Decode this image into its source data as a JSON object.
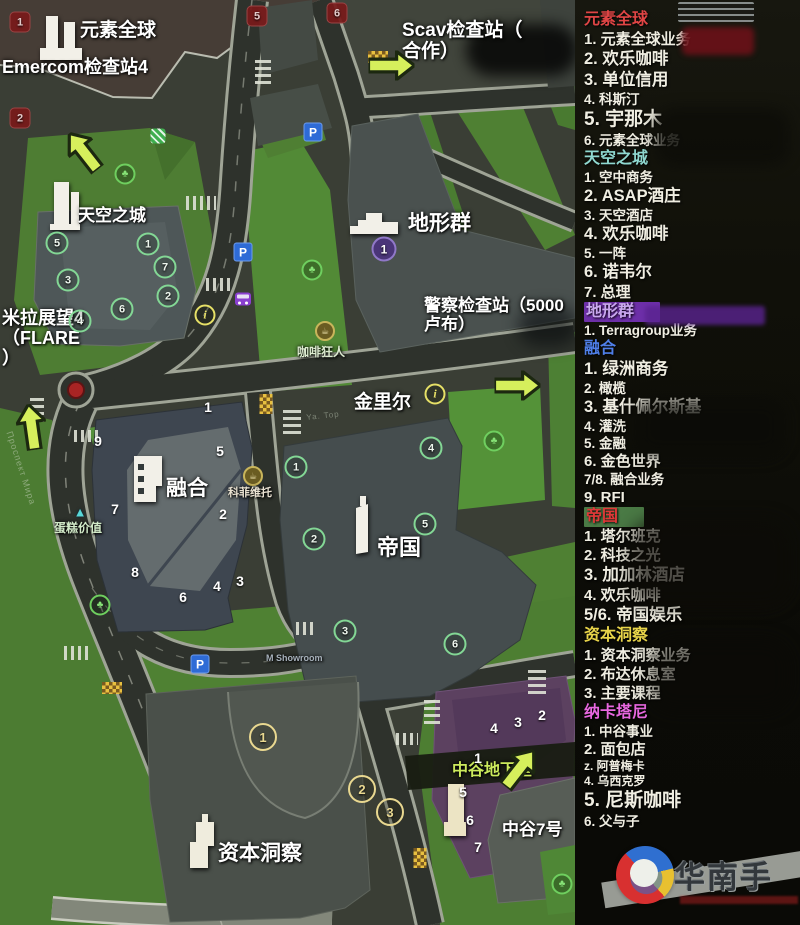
{
  "panel": {
    "sections": [
      {
        "id": "yuansuquanqiu",
        "title": "元素全球",
        "color": "#e04545",
        "bg": "",
        "items": [
          {
            "num": "1.",
            "text": "元素全球业务",
            "size": "md"
          },
          {
            "num": "2.",
            "text": "欢乐咖啡",
            "size": "lg"
          },
          {
            "num": "3.",
            "text": "单位信用",
            "size": "lg"
          },
          {
            "num": "4.",
            "text": "科斯汀",
            "size": "sm"
          },
          {
            "num": "5.",
            "text": "宇那木",
            "size": "xl"
          },
          {
            "num": "6.",
            "text": "元素全球业务",
            "size": "sm"
          }
        ]
      },
      {
        "id": "tiankongzhicheng",
        "title": "天空之城",
        "color": "#8fd8d0",
        "bg": "",
        "items": [
          {
            "num": "1.",
            "text": "空中商务",
            "size": "sm"
          },
          {
            "num": "2.",
            "text": "ASAP酒庄",
            "size": "lg"
          },
          {
            "num": "3.",
            "text": "天空酒店",
            "size": "sm"
          },
          {
            "num": "4.",
            "text": "欢乐咖啡",
            "size": "lg"
          },
          {
            "num": "5.",
            "text": "一阵",
            "size": "sm"
          },
          {
            "num": "6.",
            "text": "诺韦尔",
            "size": "lg"
          },
          {
            "num": "7.",
            "text": "总理",
            "size": "md"
          }
        ]
      },
      {
        "id": "dixingqun",
        "title": "地形群",
        "color": "#c9a8ee",
        "bg": "#6d2fa8",
        "items": [
          {
            "num": "1.",
            "text": "Terragroup业务",
            "size": "sm"
          }
        ]
      },
      {
        "id": "ronghe",
        "title": "融合",
        "color": "#4f7fe8",
        "bg": "",
        "items": [
          {
            "num": "1.",
            "text": "绿洲商务",
            "size": "lg"
          },
          {
            "num": "2.",
            "text": "橄榄",
            "size": "sm"
          },
          {
            "num": "3.",
            "text": "基什佩尔斯基",
            "size": "lg"
          },
          {
            "num": "4.",
            "text": "灌洗",
            "size": "sm"
          },
          {
            "num": "5.",
            "text": "金融",
            "size": "sm"
          },
          {
            "num": "6.",
            "text": "金色世界",
            "size": "md"
          },
          {
            "num": "7/8.",
            "text": "融合业务",
            "size": "sm"
          },
          {
            "num": "9.",
            "text": "RFI",
            "size": "md"
          }
        ]
      },
      {
        "id": "diguo",
        "title": "帝国",
        "color": "#e03838",
        "bg": "#4a7a45",
        "items": [
          {
            "num": "1.",
            "text": "塔尔班克",
            "size": "md"
          },
          {
            "num": "2.",
            "text": "科技之光",
            "size": "md"
          },
          {
            "num": "3.",
            "text": "加加林酒店",
            "size": "lg"
          },
          {
            "num": "4.",
            "text": "欢乐咖啡",
            "size": "md"
          },
          {
            "num": "5/6.",
            "text": "帝国娱乐",
            "size": "lg"
          }
        ]
      },
      {
        "id": "zibendongcha",
        "title": "资本洞察",
        "color": "#e8d44a",
        "bg": "",
        "items": [
          {
            "num": "1.",
            "text": "资本洞察业务",
            "size": "md"
          },
          {
            "num": "2.",
            "text": "布达休息室",
            "size": "md"
          },
          {
            "num": "3.",
            "text": "主要课程",
            "size": "md"
          }
        ]
      },
      {
        "id": "nakatani",
        "title": "纳卡塔尼",
        "color": "#e868e0",
        "bg": "",
        "items": [
          {
            "num": "1.",
            "text": "中谷事业",
            "size": "sm"
          },
          {
            "num": "2.",
            "text": "面包店",
            "size": "md"
          },
          {
            "num": "z.",
            "text": "阿普梅卡",
            "size": "xs"
          },
          {
            "num": "4.",
            "text": "乌西克罗",
            "size": "xs"
          },
          {
            "num": "5.",
            "text": "尼斯咖啡",
            "size": "xl"
          },
          {
            "num": "6.",
            "text": "父与子",
            "size": "sm"
          }
        ]
      }
    ]
  },
  "map": {
    "labels": [
      {
        "id": "yuansu",
        "text": "元素全球",
        "x": 80,
        "y": 20,
        "fs": 19
      },
      {
        "id": "emercom-checkpoint",
        "text": "Emercom检查站4",
        "x": 2,
        "y": 57,
        "fs": 18
      },
      {
        "id": "scav-checkpoint",
        "text": "Scav检查站（\n合作）",
        "x": 402,
        "y": 20,
        "fs": 19
      },
      {
        "id": "tiankong",
        "text": "天空之城",
        "x": 78,
        "y": 206,
        "fs": 17
      },
      {
        "id": "mila-flare",
        "text": "米拉展望4\n（FLARE\n）",
        "x": 2,
        "y": 308,
        "fs": 18
      },
      {
        "id": "dixing",
        "text": "地形群",
        "x": 408,
        "y": 212,
        "fs": 21
      },
      {
        "id": "police-checkpoint",
        "text": "警察检查站（5000\n卢布）",
        "x": 424,
        "y": 296,
        "fs": 17
      },
      {
        "id": "jinlier",
        "text": "金里尔",
        "x": 354,
        "y": 392,
        "fs": 19
      },
      {
        "id": "kafei-kuangren",
        "text": "咖啡狂人",
        "x": 297,
        "y": 346,
        "fs": 12,
        "color": "#dcead0"
      },
      {
        "id": "ronghe",
        "text": "融合",
        "x": 166,
        "y": 477,
        "fs": 21
      },
      {
        "id": "kefei-weituo",
        "text": "科菲维托",
        "x": 228,
        "y": 487,
        "fs": 11,
        "color": "#eae2d2"
      },
      {
        "id": "dangao-jiazhi",
        "text": "蛋糕价值",
        "x": 54,
        "y": 522,
        "fs": 12,
        "color": "#d2eac8"
      },
      {
        "id": "diguo",
        "text": "帝国",
        "x": 377,
        "y": 536,
        "fs": 22
      },
      {
        "id": "m-showroom",
        "text": "M Showroom",
        "x": 266,
        "y": 653,
        "fs": 9,
        "color": "#a8b2bc"
      },
      {
        "id": "ziben",
        "text": "资本洞察",
        "x": 218,
        "y": 842,
        "fs": 21
      },
      {
        "id": "zhonggu-dixiashi",
        "text": "中谷地下室",
        "x": 452,
        "y": 762,
        "fs": 16,
        "color": "#cbe95c"
      },
      {
        "id": "zhonggu-7",
        "text": "中谷7号",
        "x": 502,
        "y": 820,
        "fs": 17
      },
      {
        "id": "prospekt-mira-street",
        "text": "Проспект Мира",
        "x": 14,
        "y": 430,
        "fs": 9,
        "color": "rgba(205,215,195,.5)",
        "rot": 72,
        "street": true
      },
      {
        "id": "ya-top-street",
        "text": "Ya. Top",
        "x": 306,
        "y": 414,
        "fs": 8,
        "color": "rgba(205,215,195,.45)",
        "rot": -6,
        "street": true
      }
    ],
    "markers": [
      {
        "t": "red",
        "n": "1",
        "x": 20,
        "y": 22
      },
      {
        "t": "red",
        "n": "2",
        "x": 20,
        "y": 118
      },
      {
        "t": "red",
        "n": "5",
        "x": 257,
        "y": 16
      },
      {
        "t": "red",
        "n": "6",
        "x": 337,
        "y": 13
      },
      {
        "t": "green",
        "n": "5",
        "x": 57,
        "y": 243
      },
      {
        "t": "green",
        "n": "1",
        "x": 148,
        "y": 244
      },
      {
        "t": "green",
        "n": "7",
        "x": 165,
        "y": 267
      },
      {
        "t": "green",
        "n": "3",
        "x": 68,
        "y": 280
      },
      {
        "t": "green",
        "n": "2",
        "x": 168,
        "y": 296
      },
      {
        "t": "green",
        "n": "6",
        "x": 122,
        "y": 309
      },
      {
        "t": "green",
        "n": "4",
        "x": 80,
        "y": 321
      },
      {
        "t": "purple",
        "n": "1",
        "x": 384,
        "y": 249
      },
      {
        "t": "green",
        "n": "4",
        "x": 431,
        "y": 448
      },
      {
        "t": "green",
        "n": "1",
        "x": 296,
        "y": 467
      },
      {
        "t": "green",
        "n": "5",
        "x": 425,
        "y": 524
      },
      {
        "t": "green",
        "n": "2",
        "x": 314,
        "y": 539
      },
      {
        "t": "green",
        "n": "3",
        "x": 345,
        "y": 631
      },
      {
        "t": "green",
        "n": "6",
        "x": 455,
        "y": 644
      },
      {
        "t": "white",
        "n": "1",
        "x": 208,
        "y": 407
      },
      {
        "t": "white",
        "n": "9",
        "x": 98,
        "y": 441
      },
      {
        "t": "white",
        "n": "5",
        "x": 220,
        "y": 451
      },
      {
        "t": "white",
        "n": "7",
        "x": 115,
        "y": 509
      },
      {
        "t": "white",
        "n": "2",
        "x": 223,
        "y": 514
      },
      {
        "t": "white",
        "n": "8",
        "x": 135,
        "y": 572
      },
      {
        "t": "white",
        "n": "3",
        "x": 240,
        "y": 581
      },
      {
        "t": "white",
        "n": "4",
        "x": 217,
        "y": 586
      },
      {
        "t": "white",
        "n": "6",
        "x": 183,
        "y": 597
      },
      {
        "t": "yellow",
        "n": "1",
        "x": 263,
        "y": 737
      },
      {
        "t": "yellow",
        "n": "2",
        "x": 362,
        "y": 789
      },
      {
        "t": "yellow",
        "n": "3",
        "x": 390,
        "y": 812
      },
      {
        "t": "white",
        "n": "4",
        "x": 494,
        "y": 728
      },
      {
        "t": "white",
        "n": "3",
        "x": 518,
        "y": 722
      },
      {
        "t": "white",
        "n": "2",
        "x": 542,
        "y": 715
      },
      {
        "t": "white",
        "n": "1",
        "x": 478,
        "y": 758
      },
      {
        "t": "white",
        "n": "5",
        "x": 463,
        "y": 792
      },
      {
        "t": "white",
        "n": "6",
        "x": 470,
        "y": 820
      },
      {
        "t": "white",
        "n": "7",
        "x": 478,
        "y": 847
      }
    ],
    "icon_glyphs": {
      "parking": "P",
      "info": "i",
      "tree": "♣",
      "coffee": "☕",
      "cake": "▲",
      "bus": "",
      "esc": "",
      "checker": ""
    },
    "icons": [
      {
        "t": "parking",
        "x": 313,
        "y": 132
      },
      {
        "t": "parking",
        "x": 243,
        "y": 252
      },
      {
        "t": "parking",
        "x": 200,
        "y": 664
      },
      {
        "t": "bus",
        "x": 243,
        "y": 299
      },
      {
        "t": "info",
        "x": 205,
        "y": 315
      },
      {
        "t": "info",
        "x": 435,
        "y": 394
      },
      {
        "t": "tree",
        "x": 125,
        "y": 174
      },
      {
        "t": "tree",
        "x": 312,
        "y": 270
      },
      {
        "t": "tree",
        "x": 494,
        "y": 441
      },
      {
        "t": "tree",
        "x": 100,
        "y": 605
      },
      {
        "t": "tree",
        "x": 562,
        "y": 884
      },
      {
        "t": "esc",
        "x": 158,
        "y": 136
      },
      {
        "t": "coffee",
        "x": 325,
        "y": 331
      },
      {
        "t": "coffee",
        "x": 253,
        "y": 476
      },
      {
        "t": "cake",
        "x": 80,
        "y": 512
      },
      {
        "t": "checker",
        "x": 266,
        "y": 404,
        "w": 13,
        "h": 20
      },
      {
        "t": "checker",
        "x": 420,
        "y": 858,
        "w": 13,
        "h": 20
      },
      {
        "t": "checker",
        "x": 378,
        "y": 57,
        "w": 20,
        "h": 12
      },
      {
        "t": "checker",
        "x": 112,
        "y": 688,
        "w": 20,
        "h": 12
      }
    ],
    "arrows": [
      {
        "x": 70,
        "y": 128,
        "rot": -38
      },
      {
        "x": 374,
        "y": 40,
        "rot": 90
      },
      {
        "x": 17,
        "y": 404,
        "rot": -8
      },
      {
        "x": 500,
        "y": 360,
        "rot": 90
      },
      {
        "x": 503,
        "y": 745,
        "rot": 38
      }
    ],
    "crosswalks": [
      {
        "x": 255,
        "y": 56,
        "w": 16,
        "h": 28,
        "deg": 0
      },
      {
        "x": 186,
        "y": 196,
        "w": 30,
        "h": 14,
        "deg": 90
      },
      {
        "x": 206,
        "y": 278,
        "w": 28,
        "h": 13,
        "deg": 90
      },
      {
        "x": 283,
        "y": 408,
        "w": 18,
        "h": 26,
        "deg": 0
      },
      {
        "x": 74,
        "y": 430,
        "w": 24,
        "h": 12,
        "deg": 90
      },
      {
        "x": 30,
        "y": 396,
        "w": 14,
        "h": 26,
        "deg": 0
      },
      {
        "x": 64,
        "y": 646,
        "w": 28,
        "h": 14,
        "deg": 90
      },
      {
        "x": 296,
        "y": 622,
        "w": 20,
        "h": 13,
        "deg": 90
      },
      {
        "x": 424,
        "y": 698,
        "w": 16,
        "h": 26,
        "deg": 0
      },
      {
        "x": 528,
        "y": 670,
        "w": 18,
        "h": 24,
        "deg": 0
      },
      {
        "x": 396,
        "y": 733,
        "w": 22,
        "h": 12,
        "deg": 90
      }
    ],
    "censors": [
      {
        "x": 466,
        "y": 24,
        "w": 112,
        "h": 52,
        "bg": "#000000",
        "blur": 7,
        "op": 0.78,
        "rad": 40
      },
      {
        "x": 518,
        "y": 306,
        "w": 60,
        "h": 40,
        "bg": "#04070a",
        "blur": 8,
        "op": 0.55,
        "rad": 40
      },
      {
        "x": 678,
        "y": 2,
        "w": 76,
        "h": 20,
        "bg": "repeating-linear-gradient(0deg,#9aa0a0 0 2px,#1a1a16 2px 6px)",
        "blur": 0,
        "op": 0.85,
        "rad": 2
      },
      {
        "x": 682,
        "y": 27,
        "w": 72,
        "h": 28,
        "bg": "#6a1118",
        "blur": 3,
        "op": 0.92,
        "rad": 6
      },
      {
        "x": 655,
        "y": 108,
        "w": 135,
        "h": 58,
        "bg": "#0d0d08",
        "blur": 7,
        "op": 0.85,
        "rad": 20
      },
      {
        "x": 645,
        "y": 306,
        "w": 120,
        "h": 19,
        "bg": "#5a2390",
        "blur": 2,
        "op": 0.8,
        "rad": 3
      },
      {
        "x": 635,
        "y": 398,
        "w": 150,
        "h": 58,
        "bg": "#0b0b07",
        "blur": 8,
        "op": 0.75,
        "rad": 20
      },
      {
        "x": 630,
        "y": 520,
        "w": 160,
        "h": 85,
        "bg": "#0d0b07",
        "blur": 9,
        "op": 0.7,
        "rad": 24
      },
      {
        "x": 650,
        "y": 640,
        "w": 140,
        "h": 70,
        "bg": "#0b0a06",
        "blur": 9,
        "op": 0.6,
        "rad": 24
      }
    ]
  },
  "watermark": {
    "text": "华南手"
  }
}
